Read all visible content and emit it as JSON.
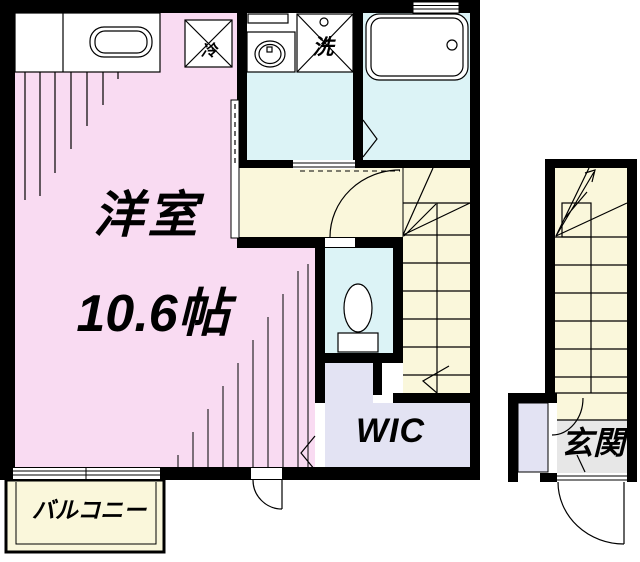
{
  "plan": {
    "labels": {
      "main_room_name": "洋室",
      "main_room_size": "10.6帖",
      "wic": "WIC",
      "entrance": "玄関",
      "balcony": "バルコニー",
      "refrigerator_mark": "冷",
      "washing_machine_mark": "洗"
    },
    "colors": {
      "main_room": "#F9DBF2",
      "wet_area": "#DCF3F6",
      "hall_stairs": "#FAF7DB",
      "closet": "#E3E3F3",
      "entry_floor": "#E7E7E7",
      "wall": "#000000"
    }
  }
}
